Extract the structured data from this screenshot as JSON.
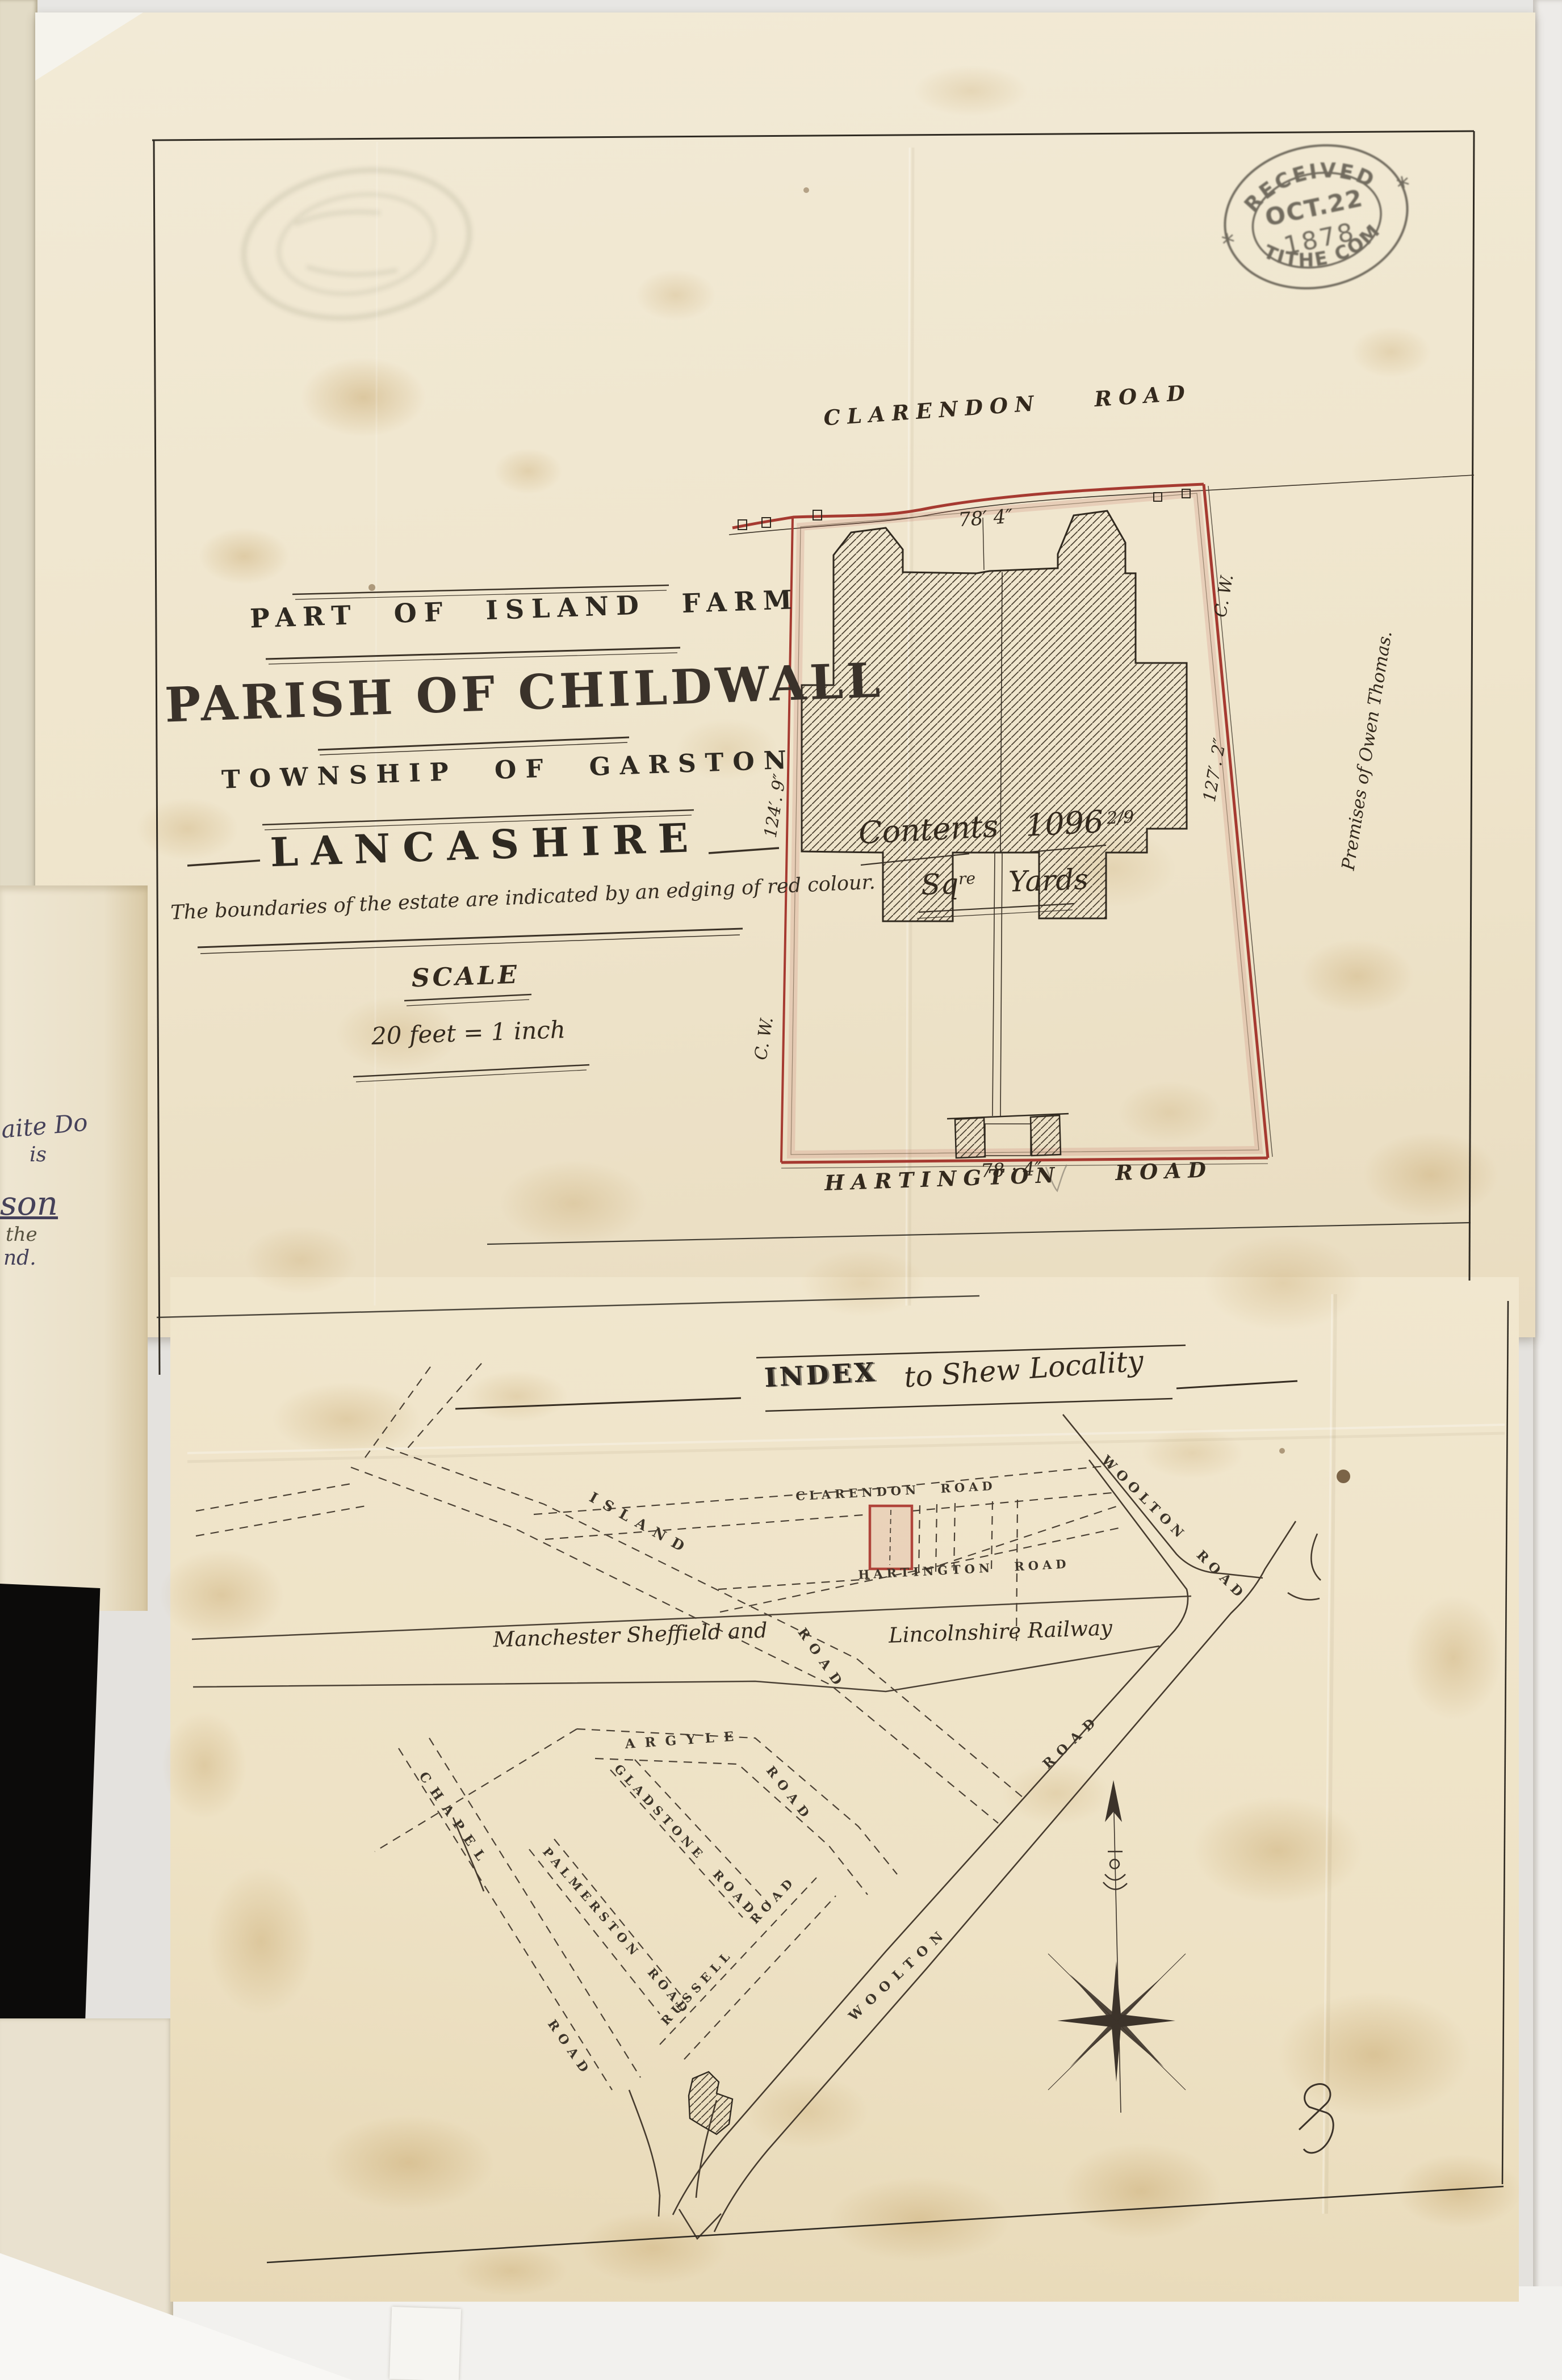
{
  "document": {
    "received_stamp": {
      "top": "RECEIVED",
      "date": "OCT.22",
      "year": "1878",
      "bottom": "TITHE COM",
      "star": "*"
    },
    "title_block": {
      "line1": "PART OF ISLAND FARM",
      "line2": "PARISH OF CHILDWALL",
      "line3": "TOWNSHIP OF GARSTON",
      "line4": "LANCASHIRE"
    },
    "boundary_note": "The boundaries of the estate are indicated by an edging of red colour.",
    "scale": {
      "label": "SCALE",
      "value": "20 feet = 1 inch"
    }
  },
  "plan": {
    "road_top": "CLARENDON ROAD",
    "road_bottom": "HARTINGTON ROAD",
    "frontage_top": "78′ 4″",
    "frontage_bottom": "78 : 4″",
    "side_left": {
      "dim": "124′. 9″",
      "wall": "C. W."
    },
    "side_right": {
      "dim": "127′. 2″",
      "wall": "C. W."
    },
    "contents": {
      "label": "Contents",
      "value": "1096",
      "fraction": "2/9",
      "unit_a": "Sq",
      "unit_a_sup": "re",
      "unit_b": "Yards"
    },
    "premises_note": "Premises of Owen Thomas."
  },
  "index_map": {
    "heading": {
      "word": "INDEX",
      "script": "to Shew Locality"
    },
    "streets": {
      "island": "ISLAND",
      "island_road": "ROAD",
      "clarendon": "CLARENDON ROAD",
      "hartington": "HARTINGTON ROAD",
      "woolton_upper": "WOOLTON ROAD",
      "woolton_lower_a": "WOOLTON",
      "woolton_lower_b": "ROAD",
      "argyle": "ARGYLE",
      "argyle_road": "ROAD",
      "gladstone": "GLADSTONE ROAD",
      "palmerston": "PALMERSTON ROAD",
      "russell": "RUSSELL",
      "russell_road": "ROAD",
      "chapel": "CHAPEL",
      "chapel_road": "ROAD"
    },
    "railway": {
      "part1": "Manchester Sheffield and",
      "part2": "Lincolnshire Railway"
    }
  },
  "margin_page_fragments": {
    "f1": "aite Do",
    "f2": "is",
    "f3": "son",
    "f4": "the",
    "f5": "nd."
  },
  "colors": {
    "boundary_red": "#a63a31",
    "paper": "#efe6cf",
    "ink": "#352c21"
  }
}
